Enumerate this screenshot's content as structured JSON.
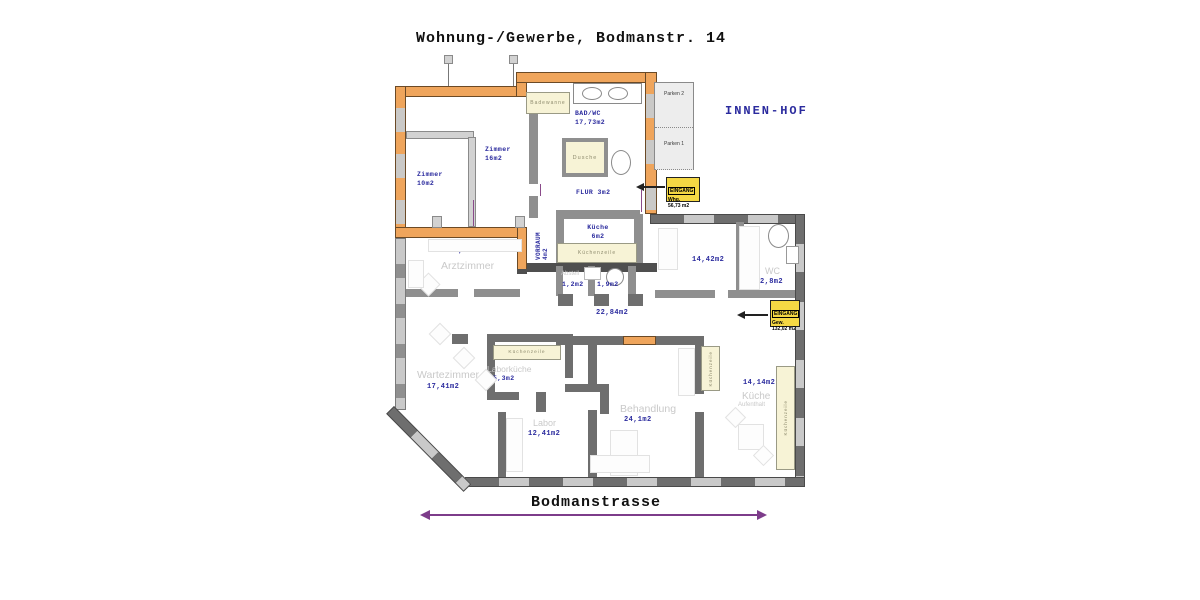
{
  "title": "Wohnung-/Gewerbe, Bodmanstr. 14",
  "innen_hof": "INNEN-HOF",
  "street": "Bodmanstrasse",
  "parking": {
    "spot2": "Parken 2",
    "spot1": "Parken 1"
  },
  "eingang_whg": {
    "line1": "EINGANG",
    "line2": "Whg.",
    "line3": "56,73 m2"
  },
  "eingang_gew": {
    "line1": "EINGANG",
    "line2": "Gew.",
    "line3": "132,02 m2"
  },
  "apartment": {
    "zimmer10_name": "Zimmer",
    "zimmer10_area": "10m2",
    "zimmer16_name": "Zimmer",
    "zimmer16_area": "16m2",
    "badwc_name": "BAD/WC",
    "badwc_area": "17,73m2",
    "badewanne": "Badewanne",
    "dusche": "Dusche",
    "flur": "FLUR 3m2",
    "vorraum_name": "VORRAUM",
    "vorraum_area": "4m2",
    "kueche_name": "Küche",
    "kueche_area": "6m2",
    "kuechenzeile": "Küchenzeile"
  },
  "gewerbe": {
    "arzt_area": "15,5m2",
    "arzt_name": "Arztzimmer",
    "warte_name": "Wartezimmer",
    "warte_area": "17,41m2",
    "laborkueche_zeile": "Küchenzeile",
    "laborkueche_name": "Laborküche",
    "laborkueche_area": "5,3m2",
    "labor_name": "Labor",
    "labor_area": "12,41m2",
    "behandlung_name": "Behandlung",
    "behandlung_area": "24,1m2",
    "kueche_area": "14,14m2",
    "kueche_name": "Küche",
    "kueche_sub": "Aufenthalt",
    "zeile_mid": "Küchenzeile",
    "zeile_right": "Küchenzeile",
    "wc_name": "WC",
    "wc_area": "2,8m2",
    "abstell_name": "Abstell",
    "abstell_area": "1,2m2",
    "wc2_area": "1,9m2",
    "raum_area": "14,42m2",
    "flur_area": "22,84m2"
  },
  "colors": {
    "wall_orange": "#efa55c",
    "wall_gray": "#6e6e6e",
    "window_gray": "#c9c9c9",
    "accent_blue": "#2b2b9e",
    "entrance_yellow": "#f5d844",
    "street_purple": "#7d3c8a",
    "cabinet_beige": "#f7f3d6"
  }
}
